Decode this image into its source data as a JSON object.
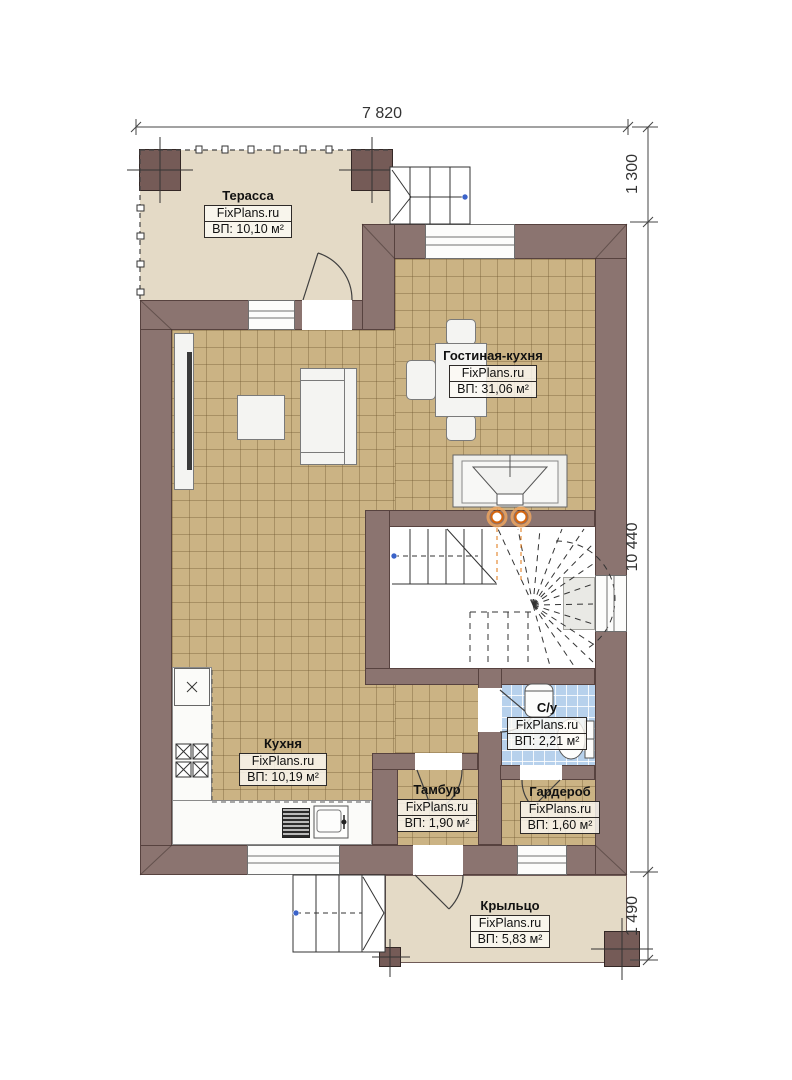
{
  "plan": {
    "dimensions": {
      "top_width": "7 820",
      "side_terrace": "1 300",
      "side_house": "10 440",
      "side_porch": "1 490"
    },
    "rooms": {
      "terrace": {
        "name": "Терасса",
        "brand": "FixPlans.ru",
        "area": "ВП: 10,10 м²"
      },
      "living": {
        "name": "Гостиная-кухня",
        "brand": "FixPlans.ru",
        "area": "ВП: 31,06 м²"
      },
      "kitchen": {
        "name": "Кухня",
        "brand": "FixPlans.ru",
        "area": "ВП: 10,19 м²"
      },
      "bathroom": {
        "name": "С/у",
        "brand": "FixPlans.ru",
        "area": "ВП: 2,21 м²"
      },
      "vestibule": {
        "name": "Тамбур",
        "brand": "FixPlans.ru",
        "area": "ВП: 1,90 м²"
      },
      "wardrobe": {
        "name": "Гардероб",
        "brand": "FixPlans.ru",
        "area": "ВП: 1,60 м²"
      },
      "porch": {
        "name": "Крыльцо",
        "brand": "FixPlans.ru",
        "area": "ВП: 5,83 м²"
      }
    },
    "colors": {
      "wall": "#8b7470",
      "tile_floor": "#cbb384",
      "terrace_floor": "#e4dac6",
      "bathroom_floor": "#b7d1ec",
      "heat_point_orange": "#e07818",
      "node_blue": "#3b63c9"
    }
  }
}
